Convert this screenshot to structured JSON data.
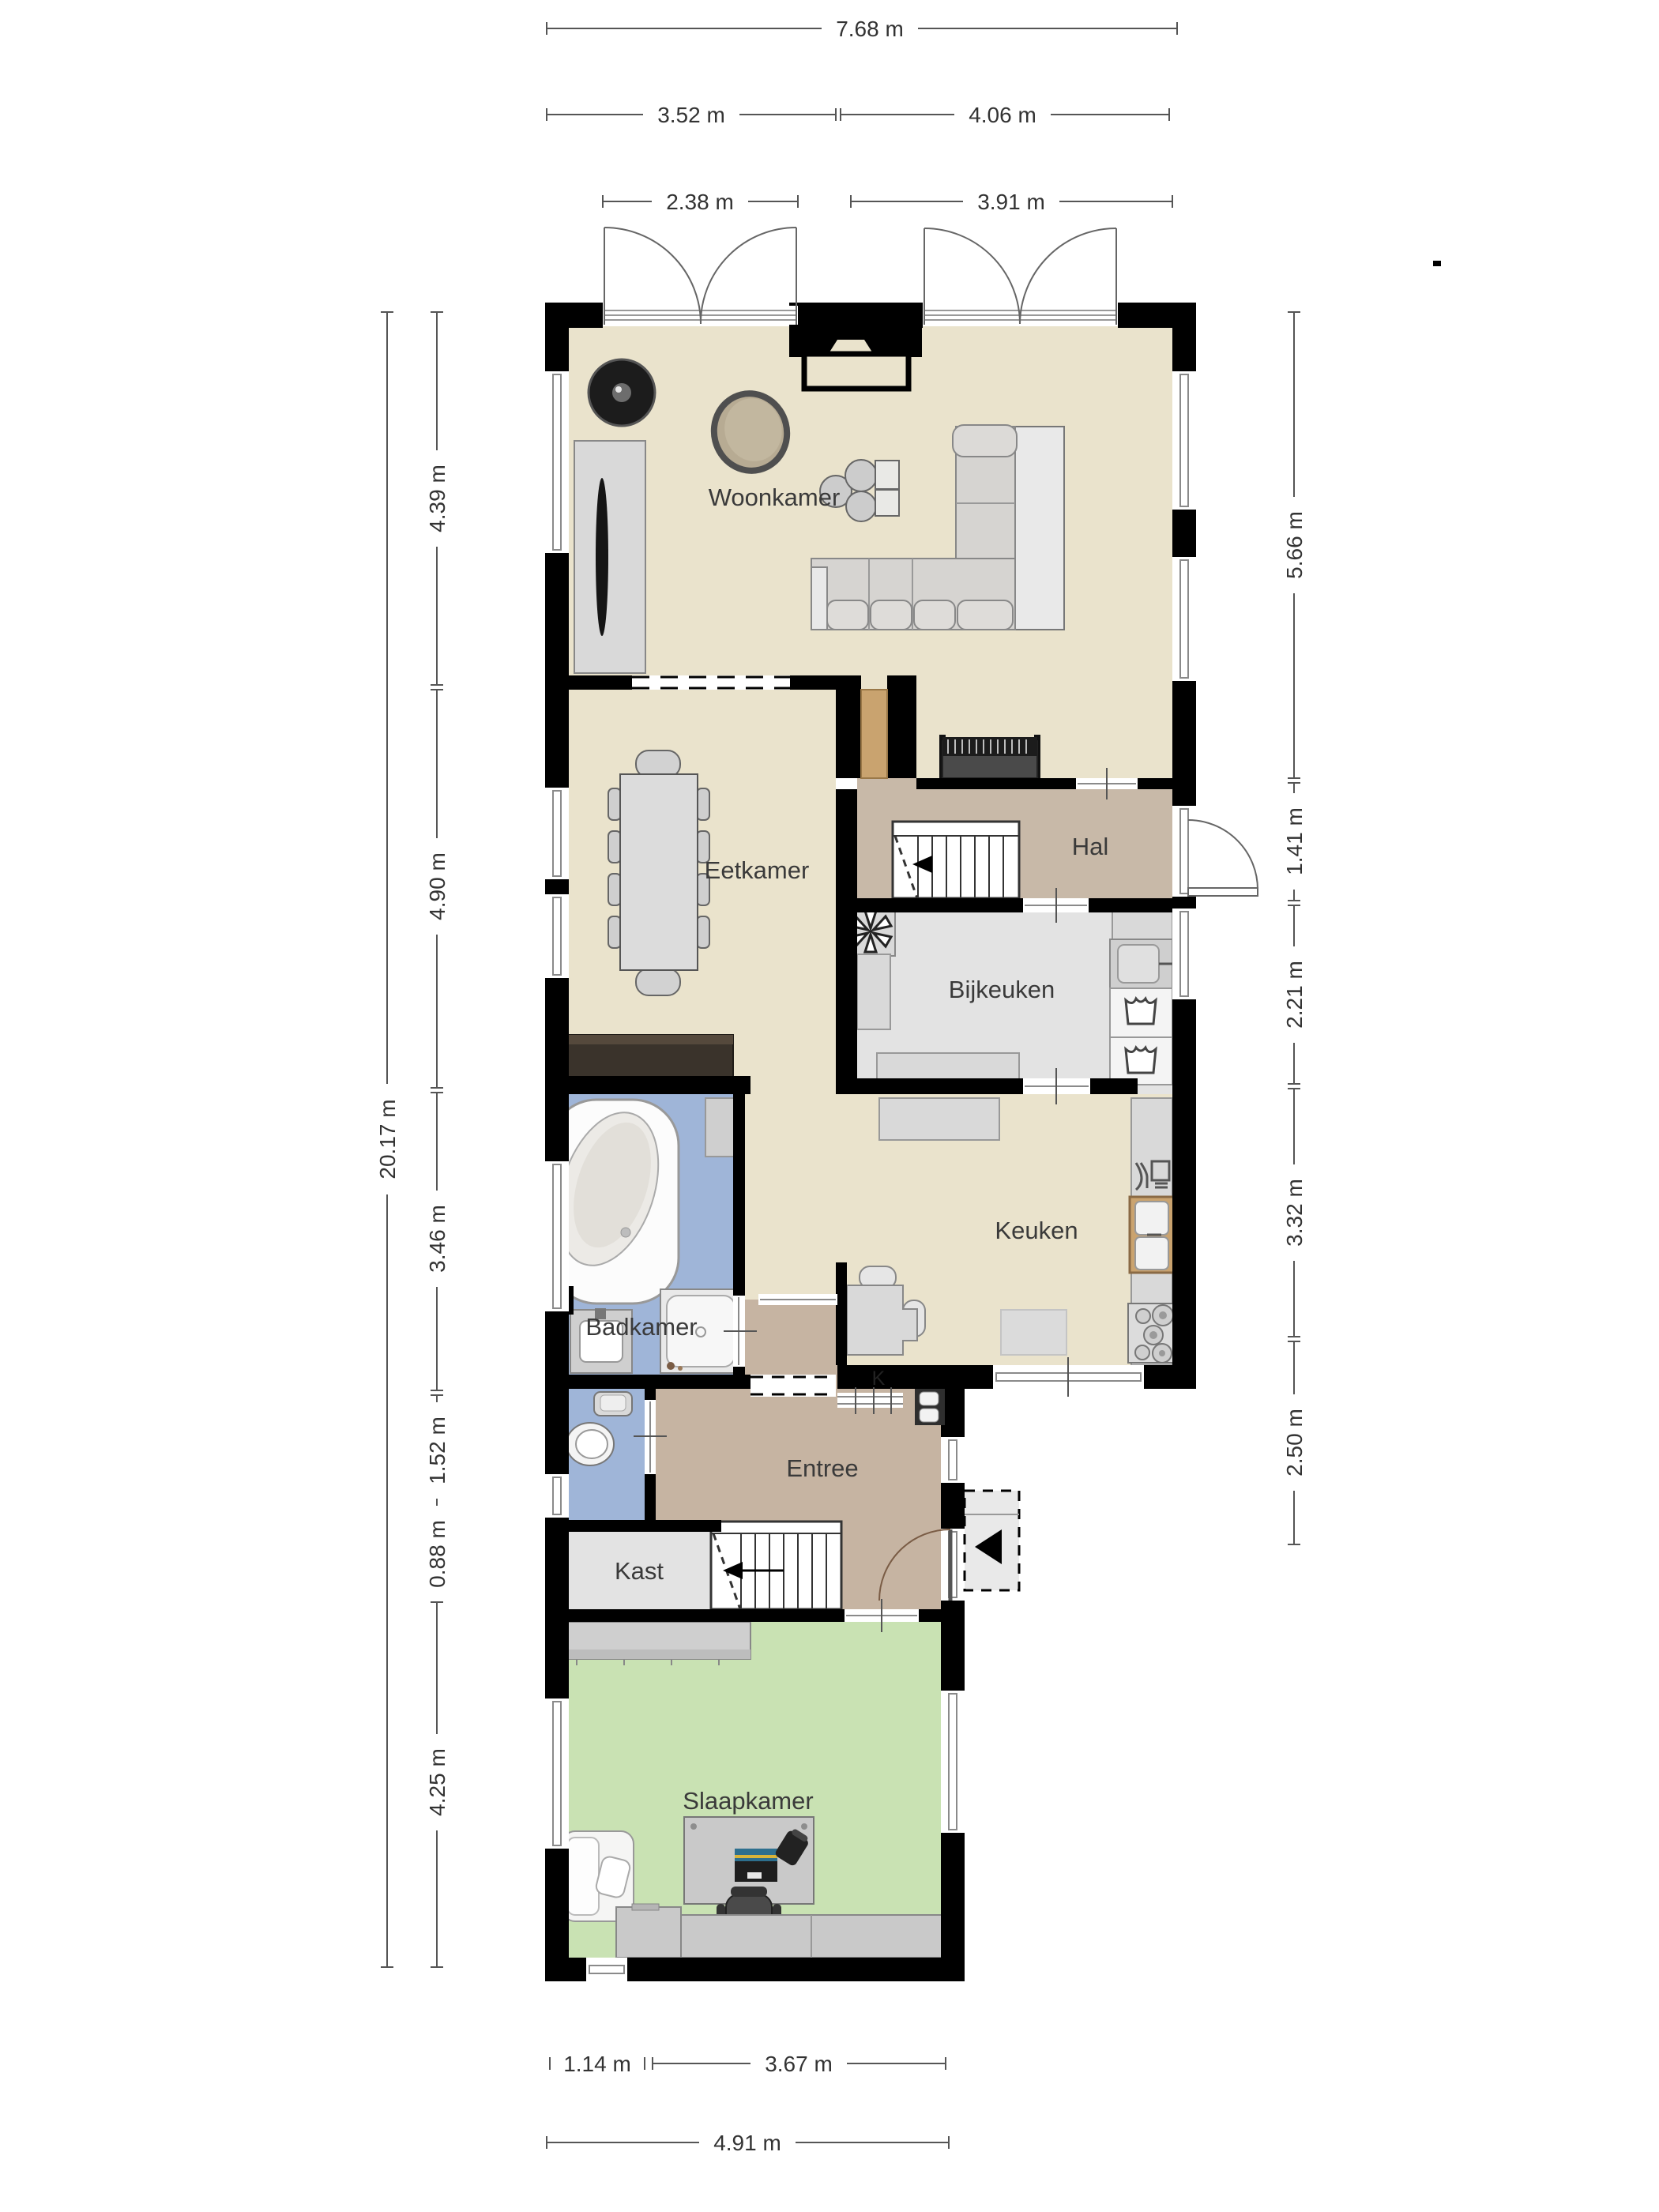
{
  "plan": {
    "type": "floor-plan",
    "closet_marker": "K"
  },
  "rooms": {
    "woonkamer": {
      "label": "Woonkamer"
    },
    "eetkamer": {
      "label": "Eetkamer"
    },
    "hal": {
      "label": "Hal"
    },
    "bijkeuken": {
      "label": "Bijkeuken"
    },
    "badkamer": {
      "label": "Badkamer"
    },
    "keuken": {
      "label": "Keuken"
    },
    "entree": {
      "label": "Entree"
    },
    "kast": {
      "label": "Kast"
    },
    "slaapkamer": {
      "label": "Slaapkamer"
    }
  },
  "dimensions": {
    "top": [
      "7.68 m",
      "3.52 m",
      "4.06 m",
      "2.38 m",
      "3.91 m"
    ],
    "left": [
      "20.17 m",
      "4.39 m",
      "4.90 m",
      "3.46 m",
      "1.52 m",
      "0.88 m",
      "4.25 m"
    ],
    "right": [
      "5.66 m",
      "1.41 m",
      "2.21 m",
      "3.32 m",
      "2.50 m"
    ],
    "bottom": [
      "1.14 m",
      "3.67 m",
      "4.91 m"
    ]
  },
  "colors": {
    "wall": "#000000",
    "floor_living": "#EAE3CC",
    "floor_hall": "#C6B6A4",
    "floor_utility": "#E3E3E3",
    "floor_bath": "#9FB5D8",
    "floor_bedroom": "#C9E2B3",
    "furniture": "#D9D9D9",
    "wood_door": "#C9A36F",
    "dimension_line": "#555555"
  }
}
